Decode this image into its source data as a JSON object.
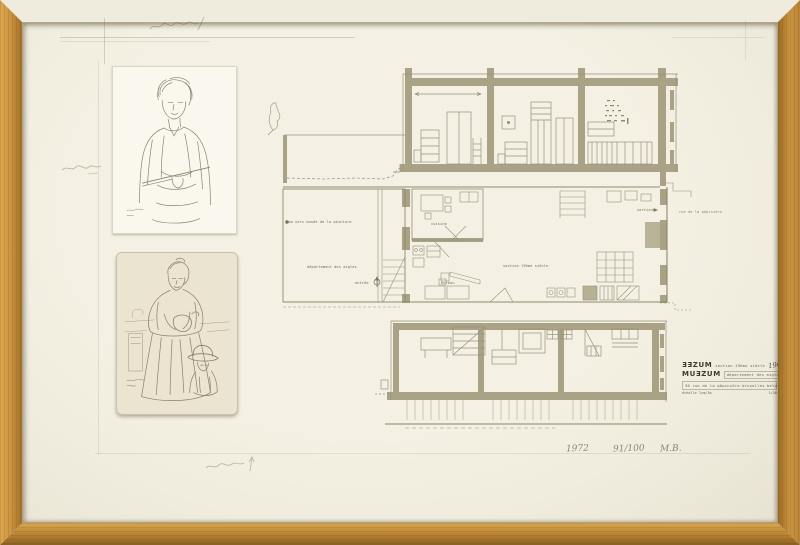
{
  "palette": {
    "frame_wood": "#c9953f",
    "paper": "#f2efe2",
    "plan_ink": "#8f896c",
    "pencil": "#b9b3a0"
  },
  "plan": {
    "labels": {
      "vers_musee": "vers musée de la peinture",
      "departement": "département des aigles",
      "entree": "entrée",
      "cuisine": "cuisine",
      "bureau": "bureau",
      "section19": "section 19ème siècle",
      "sortie": "sortie",
      "rue": "rue de la pépinière"
    }
  },
  "title_block": {
    "logo_line1": "ƎƎZUM",
    "line1_text": "section 19ème siècle",
    "line1_hand": "1968",
    "logo_line2": "MUƎZUM",
    "line2_text": "département des aigles",
    "line3": "30 rue de la pépinière  bruxelles  belgique",
    "line4_left": "échelle 1cm/1m",
    "line4_right": "1/50"
  },
  "signature": {
    "year": "1972",
    "edition": "91/100",
    "initials": "M.B."
  }
}
